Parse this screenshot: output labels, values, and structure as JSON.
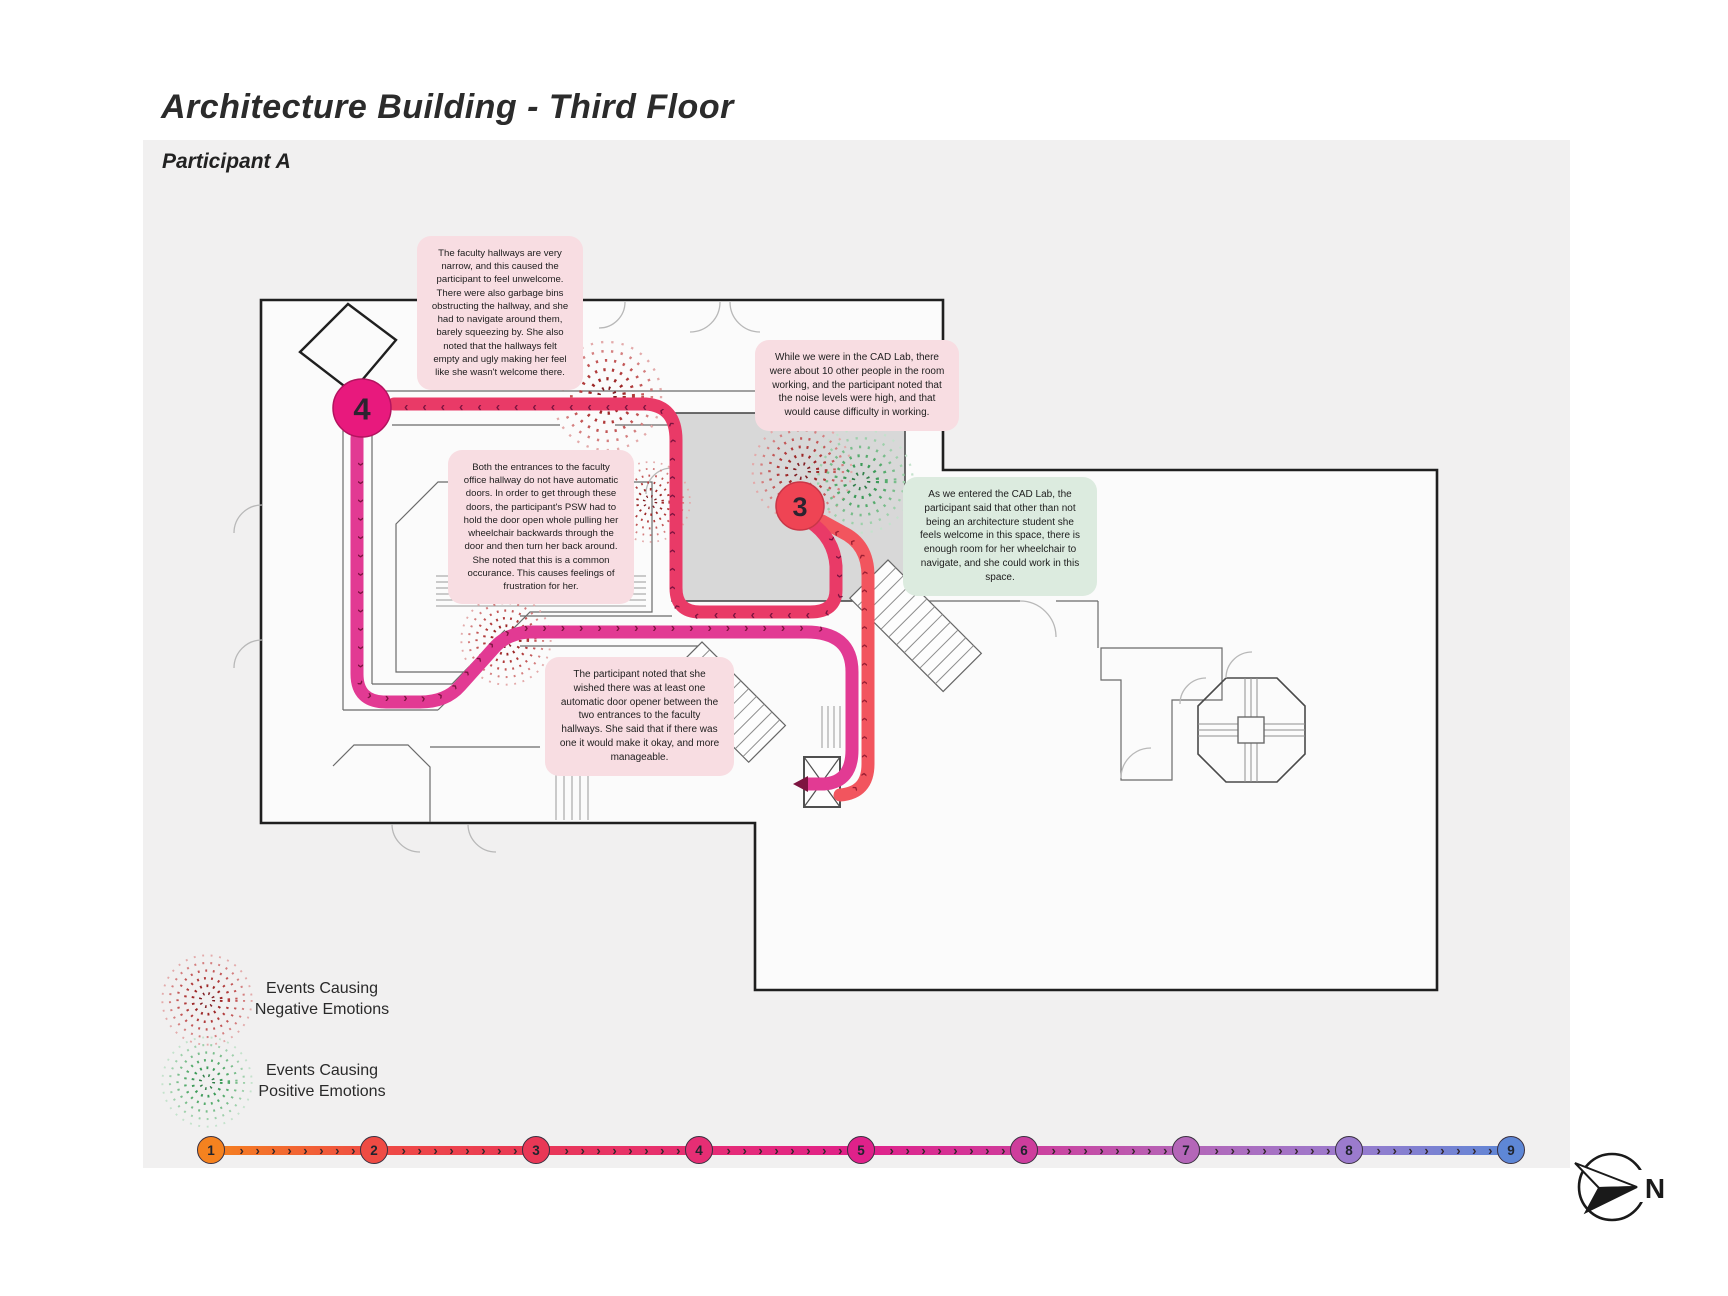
{
  "header": {
    "title": "Architecture Building - Third Floor",
    "participant": "Participant A"
  },
  "annotations": {
    "hallways_narrow": {
      "tone": "negative",
      "text": "The faculty hallways are very narrow, and this caused the participant to feel unwelcome. There were also garbage bins obstructing the hallway, and she had to navigate around them, barely squeezing by. She also noted that the hallways felt empty and ugly making her feel like she wasn't welcome there."
    },
    "cad_noise": {
      "tone": "negative",
      "text": "While we were in the CAD Lab, there were about 10 other people in the room working, and the participant noted that the noise levels were high, and that would cause difficulty in working."
    },
    "entrance_doors": {
      "tone": "negative",
      "text": "Both the entrances to the faculty office hallway do not have automatic doors. In order to get through these doors, the participant's PSW had to hold the door open whole pulling her wheelchair backwards through the door and then turn her back around. She noted that this is a common occurance. This causes feelings of frustration for her."
    },
    "cad_welcome": {
      "tone": "positive",
      "text": "As we entered the CAD Lab, the participant said that other than not being an architecture student she feels welcome in this space, there is enough room for her wheelchair to navigate, and she could work in this space."
    },
    "door_opener_wish": {
      "tone": "negative",
      "text": "The participant noted that she wished there was at least one automatic door opener between the two entrances to the faculty hallways. She said that if there was one it would make it okay, and more manageable."
    }
  },
  "map": {
    "markers": [
      {
        "label": "4",
        "color": "#E8197D"
      },
      {
        "label": "3",
        "color": "#EF4454"
      }
    ],
    "path_chevrons": {
      "seg_2_3": "››››››››››››››››",
      "seg_3_4": "››››››››››››››››››››››››››››››››››››››››",
      "seg_4_5": "››››››››››››››››››››››››››››››››››››››››"
    },
    "path_colors": {
      "seg_2_3": "#F2555E",
      "seg_3_4": "#E93A67",
      "seg_4_5": "#E23A93"
    },
    "event_colors": {
      "negative": "#B03A3A",
      "positive": "#55AB6C"
    }
  },
  "legend": {
    "negative": {
      "line1": "Events Causing",
      "line2": "Negative Emotions"
    },
    "positive": {
      "line1": "Events Causing",
      "line2": "Positive Emotions"
    }
  },
  "timeline": {
    "gap_chevrons": "› › › › › › › › › ›",
    "steps": [
      {
        "label": "1",
        "color": "#F5821F"
      },
      {
        "label": "2",
        "color": "#EF4B44"
      },
      {
        "label": "3",
        "color": "#E93856"
      },
      {
        "label": "4",
        "color": "#E62E74"
      },
      {
        "label": "5",
        "color": "#E0218A"
      },
      {
        "label": "6",
        "color": "#CE3D9C"
      },
      {
        "label": "7",
        "color": "#B466B8"
      },
      {
        "label": "8",
        "color": "#9B7BCD"
      },
      {
        "label": "9",
        "color": "#5E87D6"
      }
    ]
  },
  "compass": {
    "label": "N"
  }
}
